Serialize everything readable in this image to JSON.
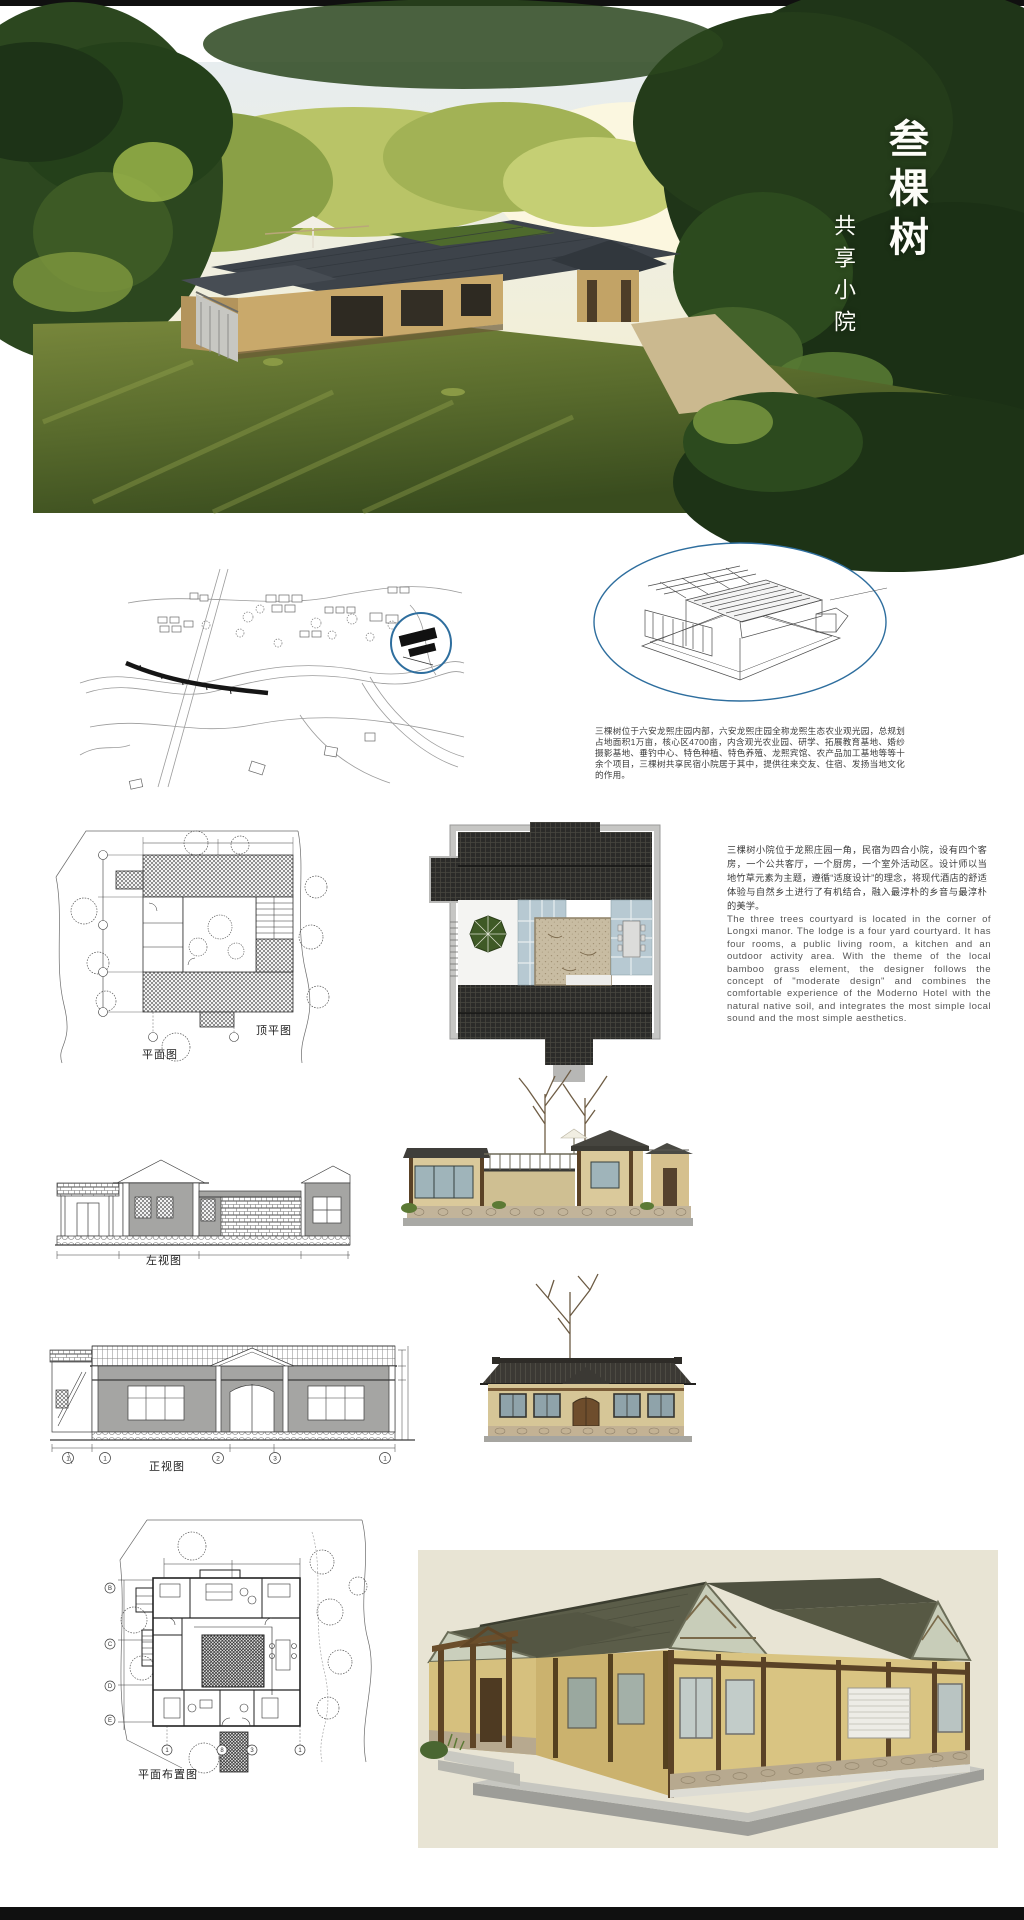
{
  "poster": {
    "title_vertical": "叁棵树",
    "subtitle_vertical": "共享小院"
  },
  "texts": {
    "site_intro_cn": "三棵树位于六安龙熙庄园内部，六安龙熙庄园全称龙熙生态农业观光园，总规划占地面积1万亩，核心区4700亩，内含观光农业园、研学、拓展教育基地、婚纱摄影基地、垂钓中心、特色种植、特色养殖、龙熙宾馆、农产品加工基地等等十余个项目，三棵树共享民宿小院居于其中，提供往来交友、住宿、发扬当地文化的作用。",
    "design_cn": "三棵树小院位于龙熙庄园一角，民宿为四合小院，设有四个客房，一个公共客厅，一个厨房，一个室外活动区。设计师以当地竹草元素为主题，遵循“适度设计”的理念，将现代酒店的舒适体验与自然乡土进行了有机结合，融入最淳朴的乡音与最淳朴的美学。",
    "design_en": "The three trees courtyard is located in the corner of Longxi manor. The lodge is a four yard courtyard. It has four rooms, a public living room, a kitchen and an outdoor activity area. With the theme of the local bamboo grass element, the designer follows the concept of \"moderate design\" and combines the comfortable experience of the Moderno Hotel with the natural native soil, and integrates the most simple local sound and the most simple aesthetics."
  },
  "drawing_labels": {
    "roof_plan": "顶平图",
    "floor_plan": "平面图",
    "left_elevation": "左视图",
    "front_elevation": "正视图",
    "layout_plan": "平面布置图"
  },
  "grid_bubbles": {
    "front_elevation": [
      "1",
      "1",
      "2",
      "3",
      "1"
    ],
    "layout_plan_bottom": [
      "1",
      "8",
      "3",
      "1"
    ],
    "layout_plan_left": [
      "B",
      "C",
      "D",
      "E"
    ]
  },
  "colors": {
    "accent_blue": "#2e6e9e",
    "roof_dark": "#2c2c2a",
    "skylight_blue": "#b7c9d2",
    "mat_beige": "#c9bda4",
    "umbrella_green": "#3f5a26",
    "render_wall_straw": "#d8c383",
    "render_roof_olive": "#5c5e4a",
    "timber_brown": "#5a4226",
    "render_background": "#e8e4d4"
  }
}
